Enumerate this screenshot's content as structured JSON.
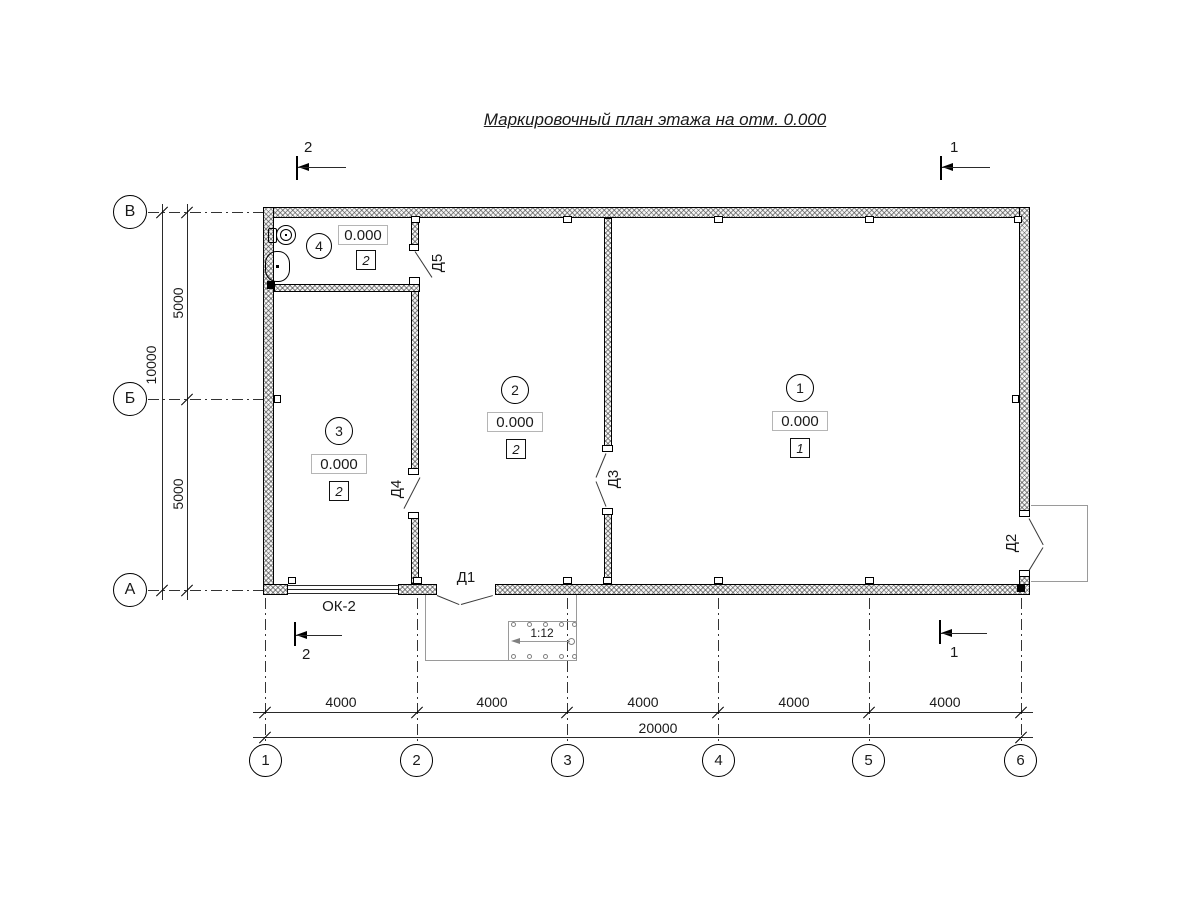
{
  "title": "Маркировочный план этажа на отм. 0.000",
  "row_axes": [
    "В",
    "Б",
    "А"
  ],
  "col_axes": [
    "1",
    "2",
    "3",
    "4",
    "5",
    "6"
  ],
  "dims": {
    "left_segments": [
      "5000",
      "5000"
    ],
    "left_total": "10000",
    "bottom_segments": [
      "4000",
      "4000",
      "4000",
      "4000",
      "4000"
    ],
    "bottom_total": "20000"
  },
  "sections": {
    "mark1": "1",
    "mark2": "2"
  },
  "rooms": [
    {
      "number": "1",
      "elevation": "0.000",
      "type_mark": "1"
    },
    {
      "number": "2",
      "elevation": "0.000",
      "type_mark": "2"
    },
    {
      "number": "3",
      "elevation": "0.000",
      "type_mark": "2"
    },
    {
      "number": "4",
      "elevation": "0.000",
      "type_mark": "2"
    }
  ],
  "doors": {
    "d1": "Д1",
    "d2": "Д2",
    "d3": "Д3",
    "d4": "Д4",
    "d5": "Д5"
  },
  "window_label": "ОК-2",
  "ramp_slope": "1:12",
  "colors": {
    "ink": "#1a1a1a",
    "muted": "#9a9a9a"
  }
}
